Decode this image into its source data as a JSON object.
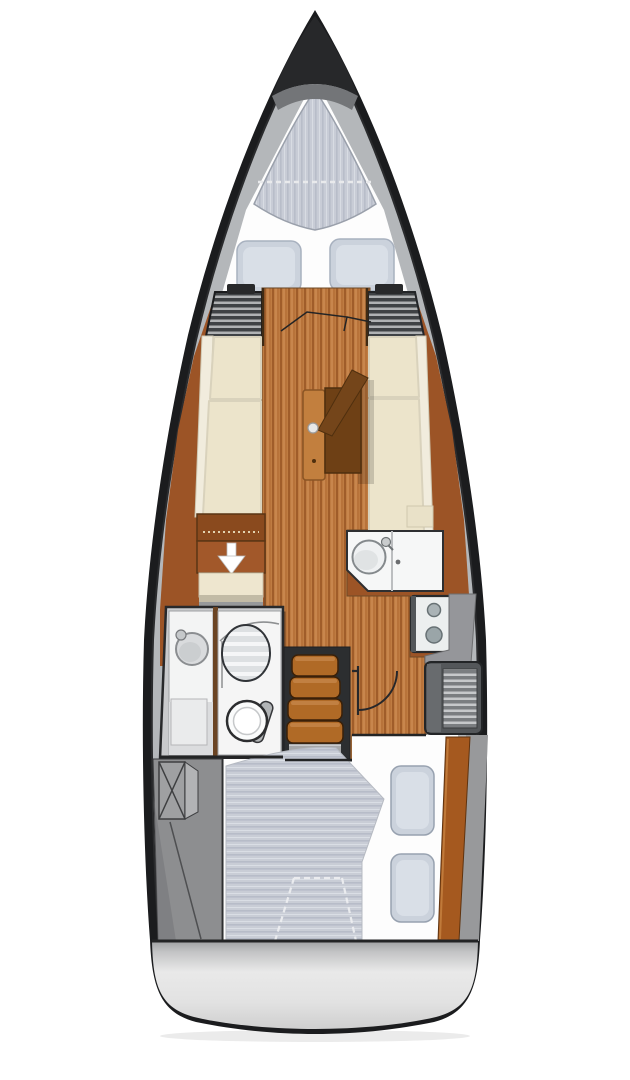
{
  "diagram": {
    "type": "sailboat-interior-floorplan",
    "view": "overhead-deck-plan",
    "orientation": "bow-up",
    "background": "#ffffff"
  },
  "colors": {
    "hull": "#1b1c1e",
    "deck_band": "#b4b7ba",
    "bedding": "#fdfdfd",
    "mattress": "#c9cdd7",
    "pillow": "#cbd2dc",
    "wood_lining": "#9c5426",
    "cushion": "#ece4cb",
    "cushion_trim": "#f1ecdd",
    "table": "#c27f3e",
    "table_dark": "#6e4015",
    "steps": "#b06a26",
    "counter": "#f6f7f7",
    "stove": "#ecefef",
    "tech_gray": "#8d8e90",
    "locker_slats": "#3f4245",
    "transom": "#d9dadb",
    "arrow": "#ffffff"
  },
  "areas": [
    {
      "id": "anchor-locker",
      "name": "anchor locker",
      "position": "bow tip"
    },
    {
      "id": "v-berth",
      "name": "forward v-berth cabin",
      "pillow_count": 2,
      "features": [
        "striped double mattress",
        "white bedding",
        "two pillows",
        "folding cabin door"
      ]
    },
    {
      "id": "saloon",
      "name": "saloon",
      "features": [
        "port settee",
        "starboard settee",
        "folding table with strut",
        "slatted bulkhead lockers",
        "wood plank sole"
      ]
    },
    {
      "id": "storage-cabinet",
      "name": "port storage cabinet",
      "features": [
        "down-arrow access marker",
        "step"
      ]
    },
    {
      "id": "galley",
      "name": "galley",
      "burner_count": 2,
      "features": [
        "round sink with faucet",
        "counter",
        "two-burner stove"
      ]
    },
    {
      "id": "head",
      "name": "head / wet room",
      "features": [
        "washbasin",
        "slatted shower seat",
        "marine toilet"
      ]
    },
    {
      "id": "companionway",
      "name": "companionway steps",
      "step_count": 4
    },
    {
      "id": "aft-cabin",
      "name": "aft double cabin",
      "pillow_count": 2,
      "features": [
        "striped double mattress",
        "door swing arc",
        "slatted vent locker",
        "wood trim"
      ]
    },
    {
      "id": "port-locker",
      "name": "port cockpit locker / technical space",
      "features": [
        "x-marked hatch",
        "diagonal seam"
      ]
    },
    {
      "id": "transom",
      "name": "transom swim platform"
    }
  ],
  "icons": {
    "down_arrow": "storage access indicator"
  }
}
